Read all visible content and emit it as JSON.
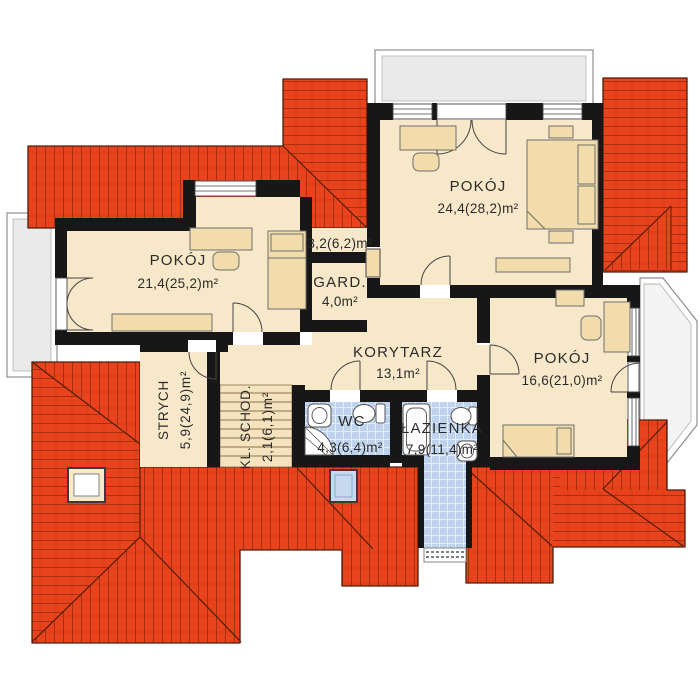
{
  "plan": {
    "type": "floor-plan",
    "floor": "upper-storey",
    "rooms": [
      {
        "name": "POKÓJ",
        "area": "21,4(25,2)m²"
      },
      {
        "name": "",
        "area": "3,2(6,2)m²"
      },
      {
        "name": "GARD.",
        "area": "4,0m²"
      },
      {
        "name": "POKÓJ",
        "area": "24,4(28,2)m²"
      },
      {
        "name": "KORYTARZ",
        "area": "13,1m²"
      },
      {
        "name": "POKÓJ",
        "area": "16,6(21,0)m²"
      },
      {
        "name": "STRYCH",
        "area": "5,9(24,9)m²"
      },
      {
        "name": "KL. SCHOD.",
        "area": "2,1(6,1)m²"
      },
      {
        "name": "WC",
        "area": "4,3(6,4)m²"
      },
      {
        "name": "ŁAZIENKA",
        "area": "7,9(11,4)m²"
      }
    ],
    "colors": {
      "roof": "#E8431C",
      "roof_line": "#8F2A0C",
      "roof_edge": "#4F1D08",
      "wall": "#171717",
      "floor": "#F8E8CA",
      "furniture": "#F3DCAC",
      "bath_tile": "#BFD4EC",
      "balcony": "#EAEAEA"
    },
    "features": {
      "balconies": 3,
      "skylights": 2,
      "bay_window": 1
    }
  }
}
